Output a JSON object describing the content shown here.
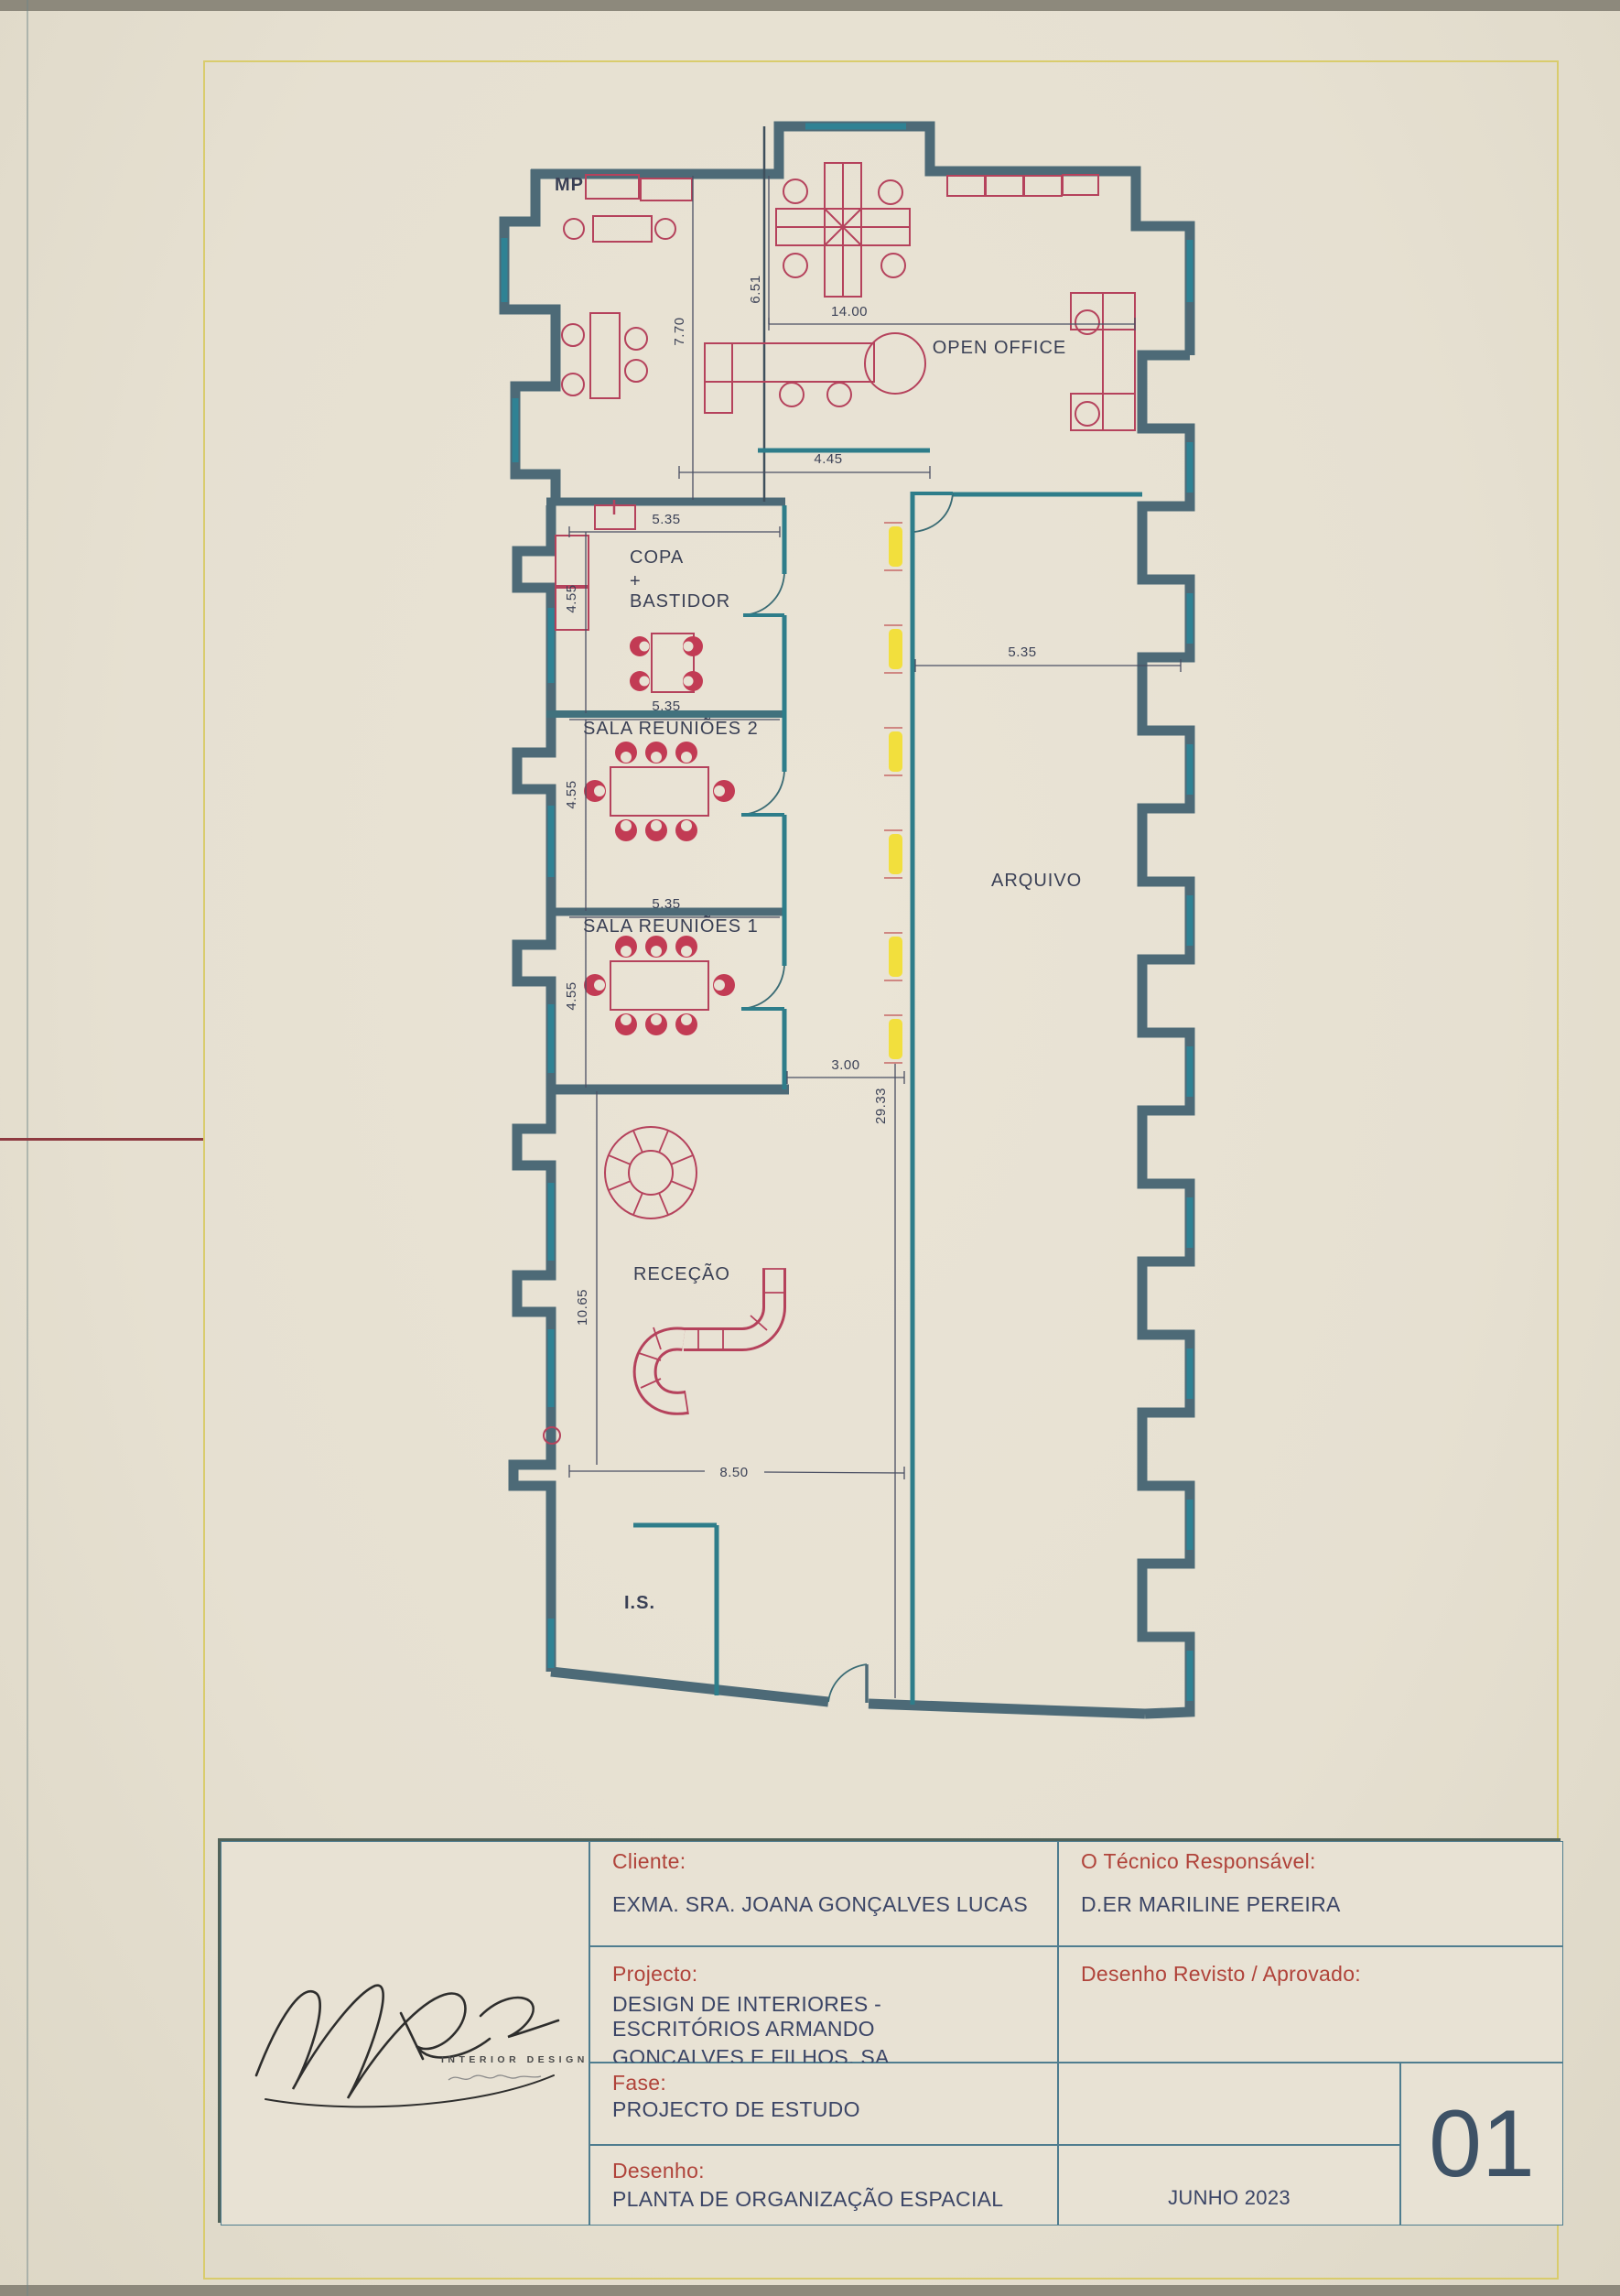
{
  "title_block": {
    "cliente_label": "Cliente:",
    "cliente_value": "EXMA. SRA. JOANA GONÇALVES LUCAS",
    "projecto_label": "Projecto:",
    "projecto_line1": "DESIGN DE INTERIORES - ESCRITÓRIOS ARMANDO",
    "projecto_line2": "GONÇALVES E FILHOS, SA",
    "fase_label": "Fase:",
    "fase_value": "PROJECTO DE ESTUDO",
    "desenho_label": "Desenho:",
    "desenho_value": "PLANTA DE ORGANIZAÇÃO ESPACIAL",
    "tecnico_label": "O Técnico Responsável:",
    "tecnico_value": "D.ER MARILINE PEREIRA",
    "revisto_label": "Desenho Revisto / Aprovado:",
    "date": "JUNHO 2023",
    "sheet_number": "01",
    "logo_brand": "INTERIOR DESIGN"
  },
  "plan": {
    "labels": {
      "open_office": "OPEN OFFICE",
      "copa_1": "COPA",
      "copa_2": "+",
      "copa_3": "BASTIDOR",
      "sala_reunioes_2": "SALA REUNIÕES 2",
      "sala_reunioes_1": "SALA REUNIÕES 1",
      "arquivo": "ARQUIVO",
      "rececao": "RECEÇÃO",
      "is": "I.S.",
      "mp": "MP"
    },
    "dimensions": {
      "open_office_width": "14.00",
      "open_office_left": "6.51",
      "left_room_height": "7.70",
      "partition": "4.45",
      "copa_width": "5.35",
      "copa_height": "4.55",
      "sr2_width": "5.35",
      "sr2_height": "4.55",
      "sr1_width": "5.35",
      "sr1_height": "4.55",
      "arquivo_width": "5.35",
      "corridor_width": "3.00",
      "building_length": "29.33",
      "rececao_height": "10.65",
      "bottom_width": "8.50"
    },
    "colors": {
      "wall": "#4d6a77",
      "partition": "#2e7d8a",
      "furniture": "#b5425c",
      "chair_fill": "#c23b54",
      "light": "#f2df3d",
      "dimension": "#3c4257",
      "frame_line": "#d9cc6d"
    }
  }
}
